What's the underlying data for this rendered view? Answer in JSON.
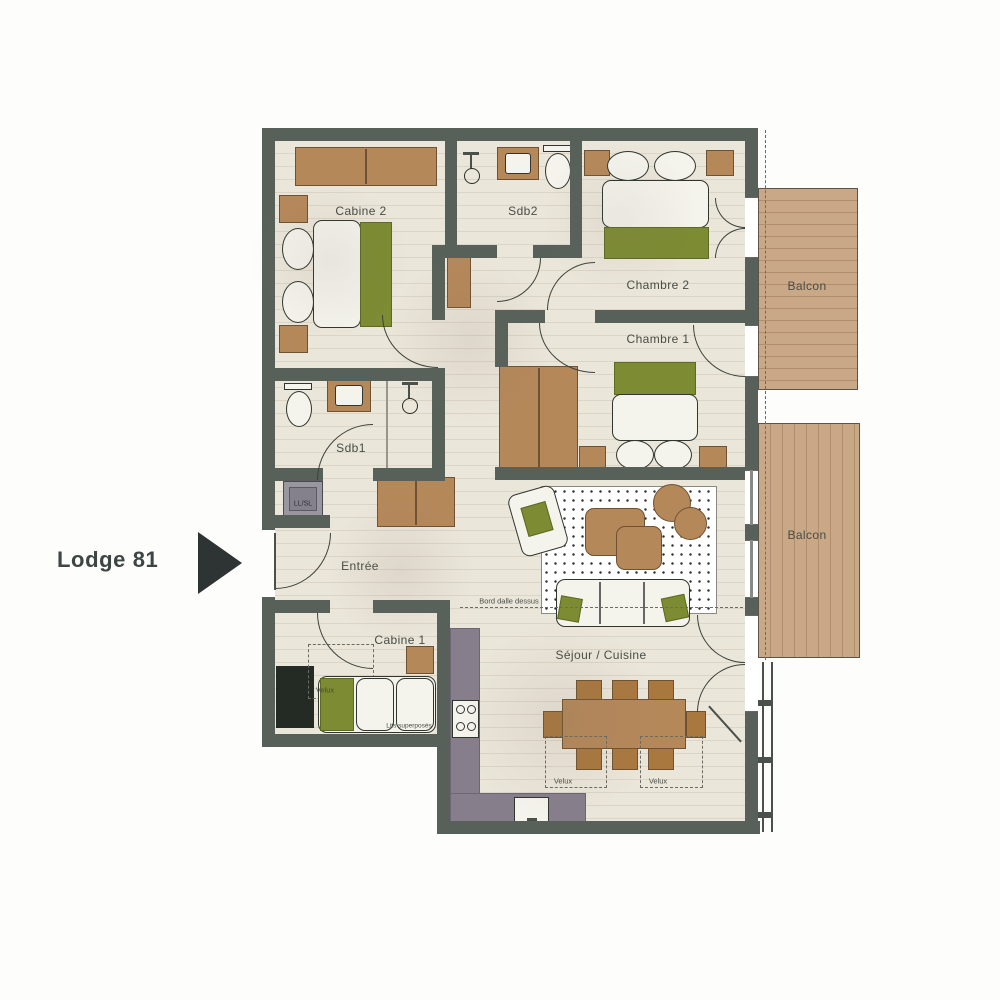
{
  "title": "Lodge 81",
  "labels": {
    "lodge": "Lodge 81",
    "cabine2": "Cabine 2",
    "sdb2": "Sdb2",
    "chambre2": "Chambre 2",
    "chambre1": "Chambre 1",
    "balcon_top": "Balcon",
    "balcon_bottom": "Balcon",
    "sdb1": "Sdb1",
    "entree": "Entrée",
    "cabine1": "Cabine 1",
    "sejour": "Séjour / Cuisine"
  },
  "annotations": {
    "bord_dalle": "Bord dalle dessus",
    "velux_cabine": "Velux",
    "velux_sejour_left": "Velux",
    "velux_sejour_right": "Velux",
    "lits_superposes": "Lits superposés",
    "washer": "LL/SL"
  },
  "colors": {
    "wall": "#57615a",
    "wall_dark": "#242a24",
    "floor": "#ebe6da",
    "floor_line": "#dcd5c6",
    "wood": "#b5885a",
    "wood_dark": "#6f5233",
    "wood_chair": "#a9783f",
    "green": "#7d8b33",
    "green_dark": "#5d6a23",
    "balcony": "#c9a888",
    "balcony_line": "#b28e6b",
    "counter": "#877e8c",
    "counter_dark": "#6e6575",
    "white_obj": "#f4f3ec",
    "outline": "#30362f",
    "text": "#474c45",
    "accent_black": "#2d3433",
    "dash": "#6b6b63"
  }
}
